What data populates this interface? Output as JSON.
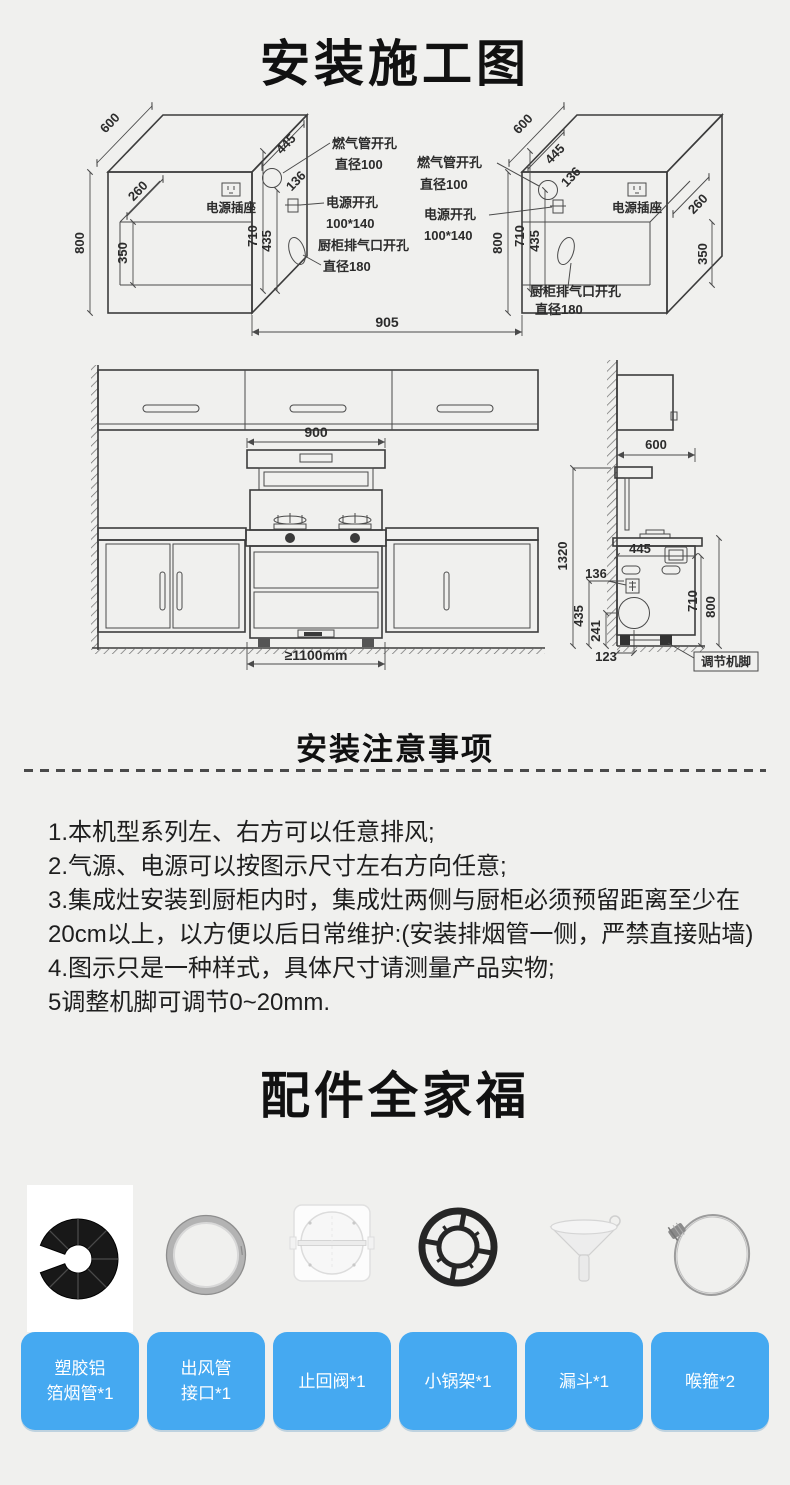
{
  "page": {
    "title": "安装施工图",
    "bg_color": "#f0f0ee",
    "accent_blue": "#45a9f1",
    "line_color": "#4a4a4a"
  },
  "install_diagram": {
    "left_box": {
      "depth": "600",
      "height": "800",
      "top_width": "445",
      "offset_136": "136",
      "inner_depth": "260",
      "inner_height": "350",
      "dim_710": "710",
      "dim_435": "435",
      "socket_label": "电源插座",
      "gas_hole_line1": "燃气管开孔",
      "gas_hole_line2": "直径100",
      "power_hole_line1": "电源开孔",
      "power_hole_line2": "100*140",
      "exhaust_hole_line1": "厨柜排气口开孔",
      "exhaust_hole_line2": "直径180"
    },
    "right_box": {
      "depth": "600",
      "height": "800",
      "top_width": "445",
      "offset_136": "136",
      "inner_depth": "260",
      "inner_height": "350",
      "dim_710": "710",
      "dim_435": "435",
      "socket_label": "电源插座",
      "gas_hole_line1": "燃气管开孔",
      "gas_hole_line2": "直径100",
      "power_hole_line1": "电源开孔",
      "power_hole_line2": "100*140",
      "exhaust_hole_line1": "厨柜排气口开孔",
      "exhaust_hole_line2": "直径180"
    },
    "niche_width": "905"
  },
  "front_view": {
    "stove_width": "900",
    "min_install_width": "≥1100mm"
  },
  "side_view": {
    "depth": "600",
    "total_height": "1320",
    "dim_445": "445",
    "dim_136": "136",
    "dim_435": "435",
    "dim_241": "241",
    "dim_123": "123",
    "dim_710": "710",
    "dim_800": "800",
    "foot_label": "调节机脚"
  },
  "notes": {
    "heading": "安装注意事项",
    "lines": [
      "1.本机型系列左、右方可以任意排风;",
      "2.气源、电源可以按图示尺寸左右方向任意;",
      "3.集成灶安装到厨柜内时，集成灶两侧与厨柜必须预留距离至少在",
      "20cm以上，以方便以后日常维护:(安装排烟管一侧，严禁直接贴墙)",
      "4.图示只是一种样式，具体尺寸请测量产品实物;",
      "5调整机脚可调节0~20mm."
    ]
  },
  "accessories": {
    "heading": "配件全家福",
    "items": [
      {
        "line1": "塑胶铝",
        "line2": "箔烟管*1"
      },
      {
        "line1": "出风管",
        "line2": "接口*1"
      },
      {
        "line1": "止回阀*1",
        "line2": ""
      },
      {
        "line1": "小锅架*1",
        "line2": ""
      },
      {
        "line1": "漏斗*1",
        "line2": ""
      },
      {
        "line1": "喉箍*2",
        "line2": ""
      }
    ]
  }
}
